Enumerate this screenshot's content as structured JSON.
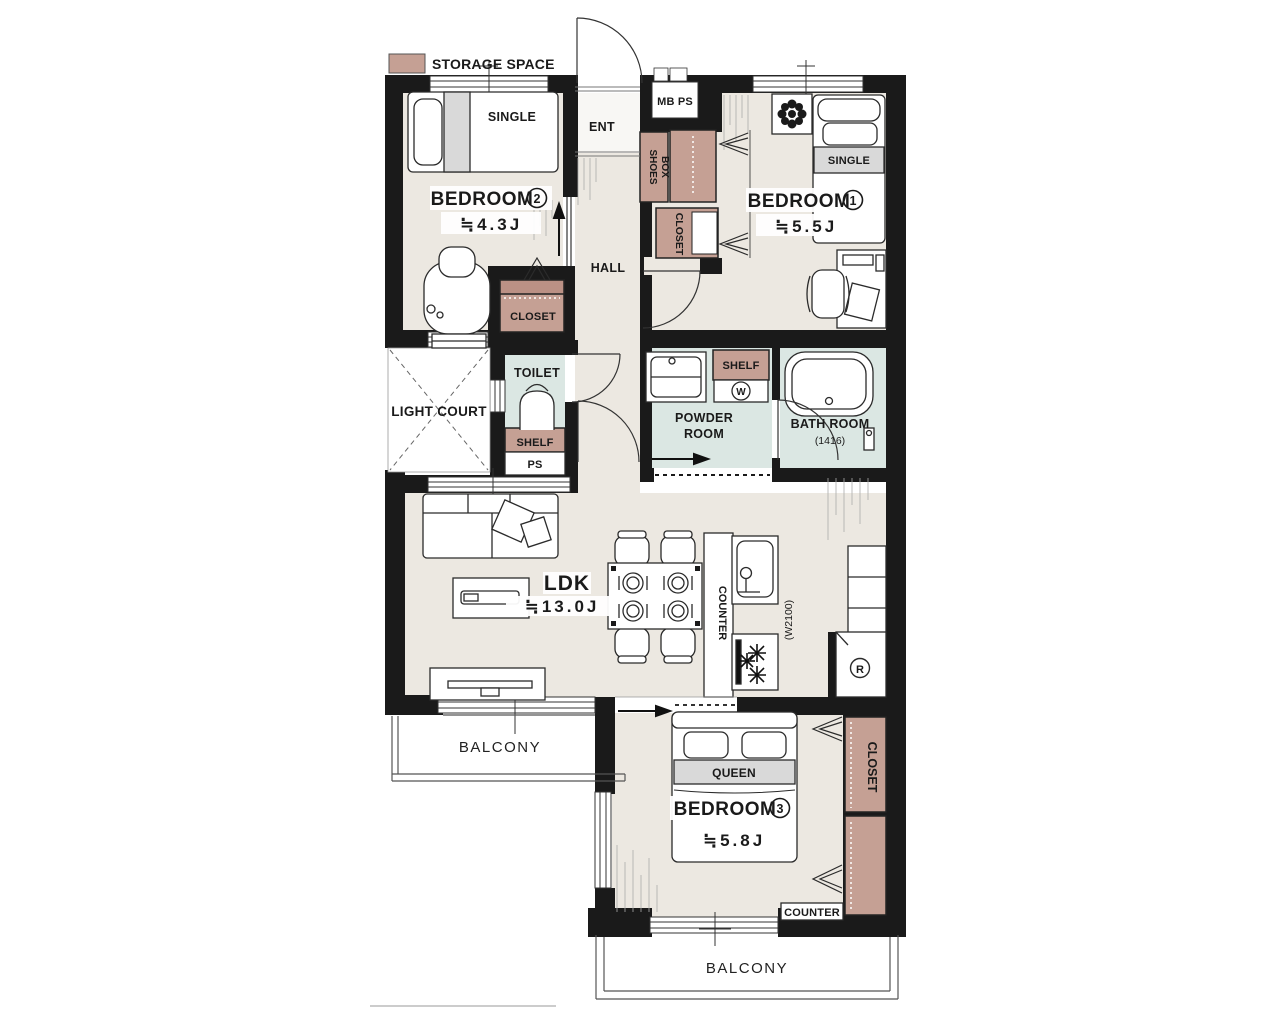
{
  "legend": {
    "storage_label": "STORAGE SPACE"
  },
  "colors": {
    "storage": "#c5a094",
    "floor": "#ece8e1",
    "wet": "#dbe7e3",
    "wall": "#1a1a1a",
    "bed_band": "#d9d9d9"
  },
  "entrance": {
    "label": "ENT",
    "meter_label": "MB PS",
    "shoes_label_1": "SHOES",
    "shoes_label_2": "BOX"
  },
  "hall": {
    "label": "HALL"
  },
  "bedroom1": {
    "label": "BEDROOM",
    "number": "1",
    "size": "≒5.5J",
    "bed": "SINGLE",
    "closet": "CLOSET"
  },
  "bedroom2": {
    "label": "BEDROOM",
    "number": "2",
    "size": "≒4.3J",
    "bed": "SINGLE",
    "closet": "CLOSET"
  },
  "bedroom3": {
    "label": "BEDROOM",
    "number": "3",
    "size": "≒5.8J",
    "bed": "QUEEN",
    "closet": "CLOSET",
    "counter": "COUNTER"
  },
  "ldk": {
    "label": "LDK",
    "size": "≒13.0J",
    "counter": "COUNTER",
    "width_note": "(W2100)",
    "fridge_letter": "R"
  },
  "toilet": {
    "label": "TOILET",
    "shelf": "SHELF",
    "ps": "PS"
  },
  "powder": {
    "label_1": "POWDER",
    "label_2": "ROOM",
    "shelf": "SHELF",
    "washer_letter": "W"
  },
  "bath": {
    "label": "BATH ROOM",
    "size": "(1416)"
  },
  "light_court": {
    "label": "LIGHT COURT"
  },
  "balcony_left": {
    "label": "BALCONY"
  },
  "balcony_bottom": {
    "label": "BALCONY"
  }
}
